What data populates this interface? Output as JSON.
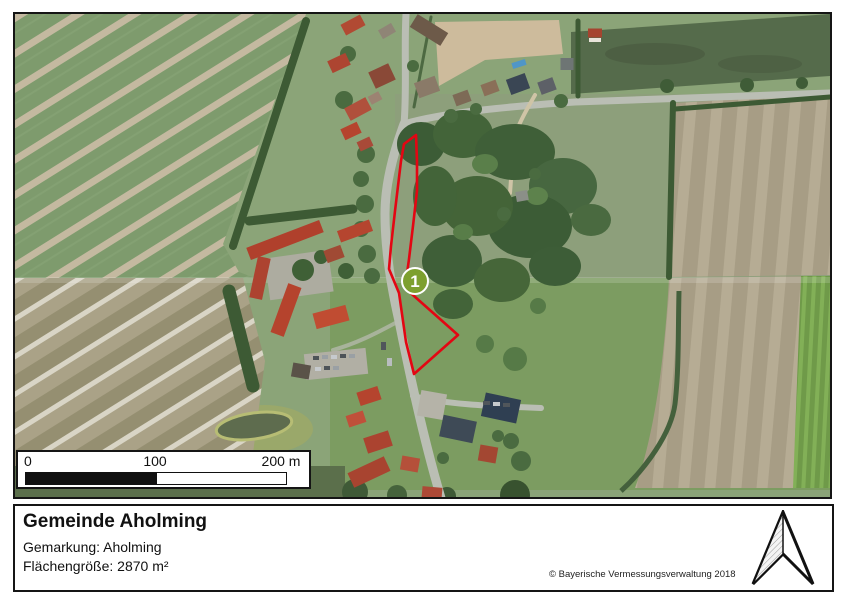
{
  "map": {
    "marker": {
      "label": "1",
      "fill_color": "#7da02f",
      "border_color": "#ffffff"
    },
    "parcel": {
      "outline_color": "#e30613"
    },
    "scale_bar": {
      "ticks": [
        "0",
        "100",
        "200 m"
      ]
    }
  },
  "footer": {
    "title": "Gemeinde Aholming",
    "gemarkung": "Gemarkung: Aholming",
    "area": "Flächengröße: 2870 m²",
    "copyright": "© Bayerische Vermessungsverwaltung 2018"
  }
}
